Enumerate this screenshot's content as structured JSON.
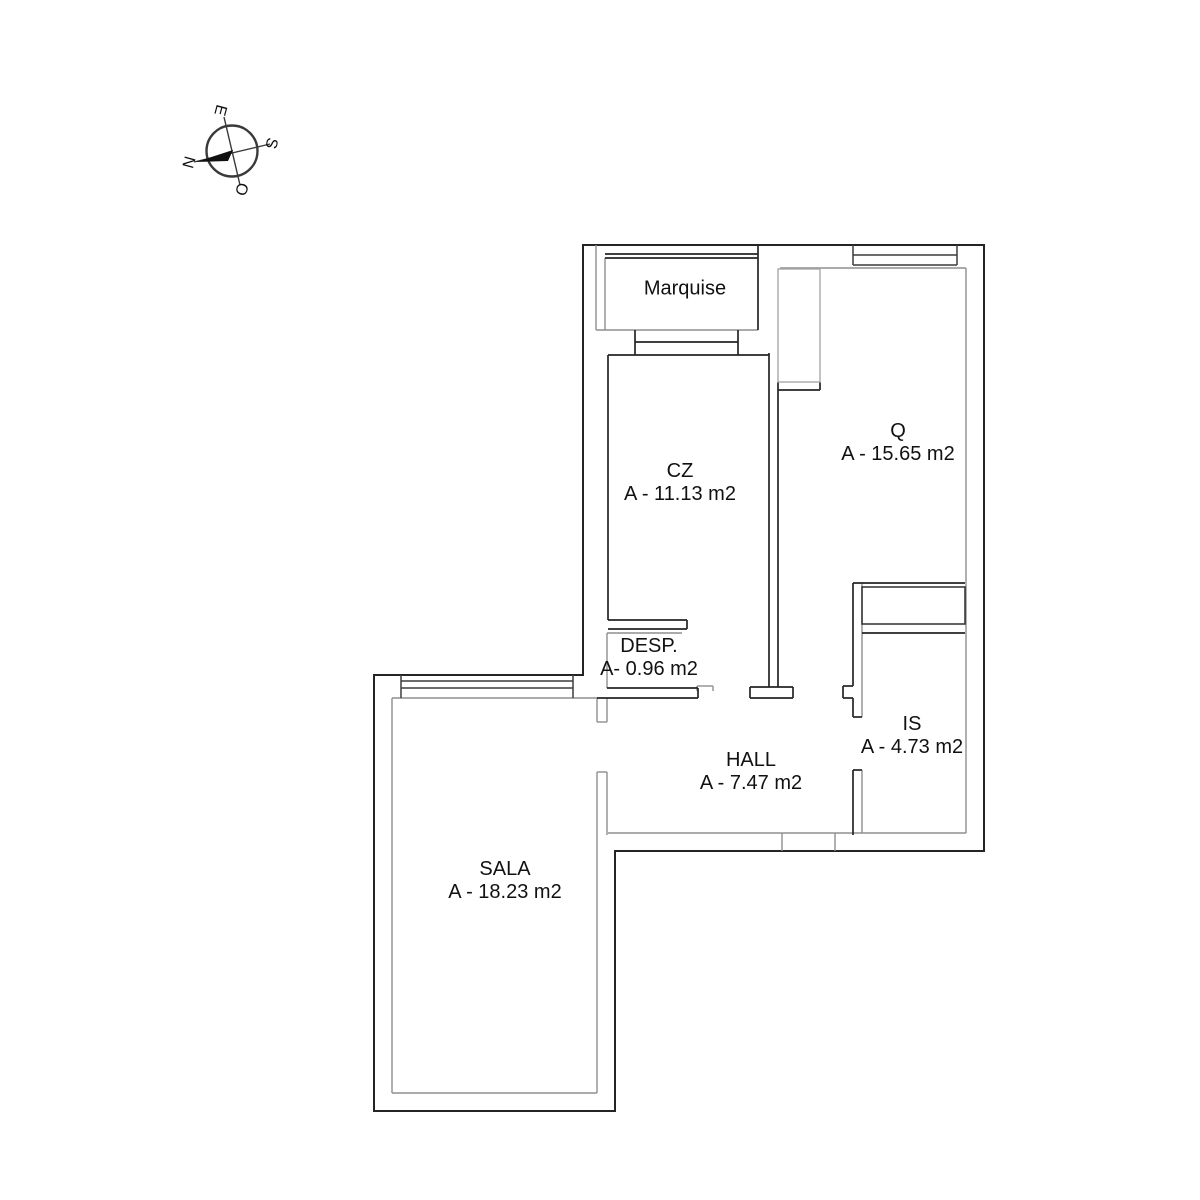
{
  "compass": {
    "n": "N",
    "e": "E",
    "s": "S",
    "o": "O"
  },
  "rooms": [
    {
      "key": "marquise",
      "name": "Marquise",
      "area": ""
    },
    {
      "key": "cz",
      "name": "CZ",
      "area": "A - 11.13 m2"
    },
    {
      "key": "q",
      "name": "Q",
      "area": "A - 15.65 m2"
    },
    {
      "key": "desp",
      "name": "DESP.",
      "area": "A- 0.96 m2"
    },
    {
      "key": "hall",
      "name": "HALL",
      "area": "A - 7.47 m2"
    },
    {
      "key": "is",
      "name": "IS",
      "area": "A - 4.73 m2"
    },
    {
      "key": "sala",
      "name": "SALA",
      "area": "A - 18.23 m2"
    }
  ],
  "colors": {
    "wall_dark": "#242424",
    "wall_gray": "#8f8f8f",
    "furniture_gray": "#a9a9a9",
    "text": "#111111",
    "background": "#ffffff"
  }
}
